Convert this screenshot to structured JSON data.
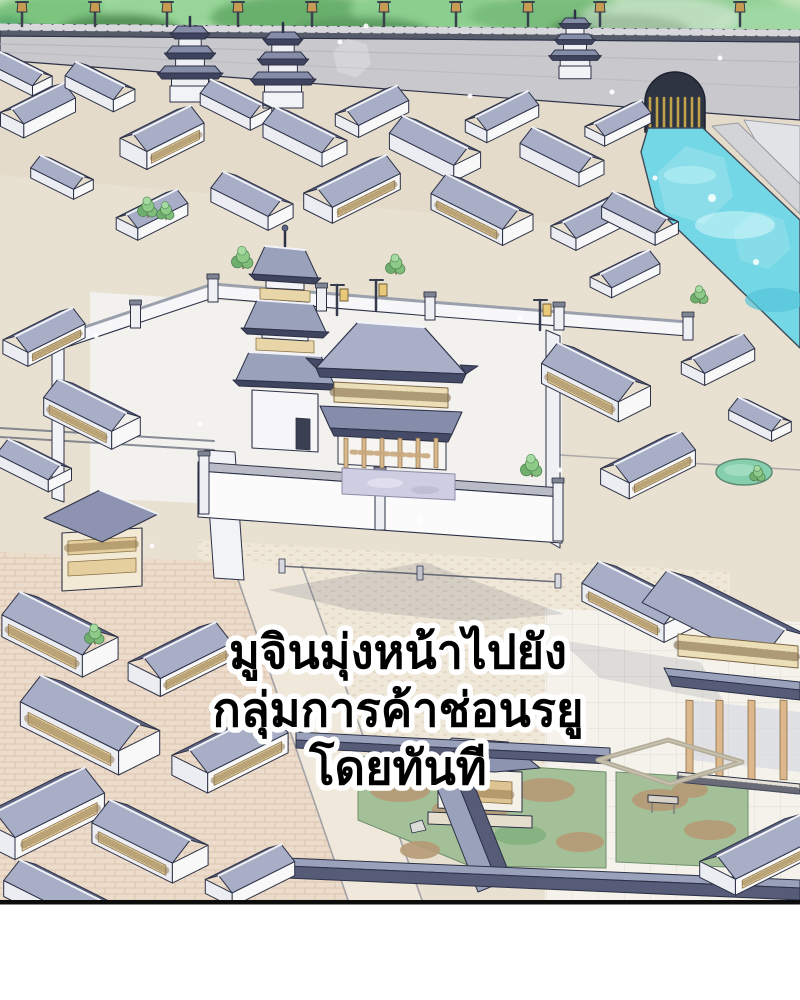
{
  "panel": {
    "media_type": "webtoon-comic-panel",
    "scene_description": "Aerial isometric view of an ancient East Asian walled city: stone rampart with lamps and gate towers backed by forest, a water-gate canal at top right, districts of blue-slate roofed buildings with white walls, a central walled compound with a three-tier pagoda and gate hall, tiled plazas, garden courtyards and covered corridors",
    "caption": {
      "lines": [
        "มูจินมุ่งหน้าไปยัง",
        "กลุ่มการค้าช่อนรยู",
        "โดยทันที"
      ],
      "text_color": "#000000",
      "outline_color": "#ffffff"
    },
    "palette": {
      "forest_green": "#7dc47f",
      "stone_wall": "#c9c9cd",
      "battlement": "#565b69",
      "roof_light": "#a8aec6",
      "roof_dark": "#5d6382",
      "roof_ridge_dark": "#3e445e",
      "wall_white": "#f8f8f9",
      "lattice_cream": "#e9d7a8",
      "wood_tan": "#d9b98c",
      "pavement_beige": "#e8e0d0",
      "brick_pavement": "#ecdccb",
      "plaza_white": "#f4f2eb",
      "water_cyan": "#74d7e6",
      "grass_green": "#a3c098",
      "dirt_brown": "#b69a76",
      "stone_floor_lavender": "#cfcde2",
      "panel_border": "#0c0c0c",
      "gutter": "#ffffff"
    }
  }
}
